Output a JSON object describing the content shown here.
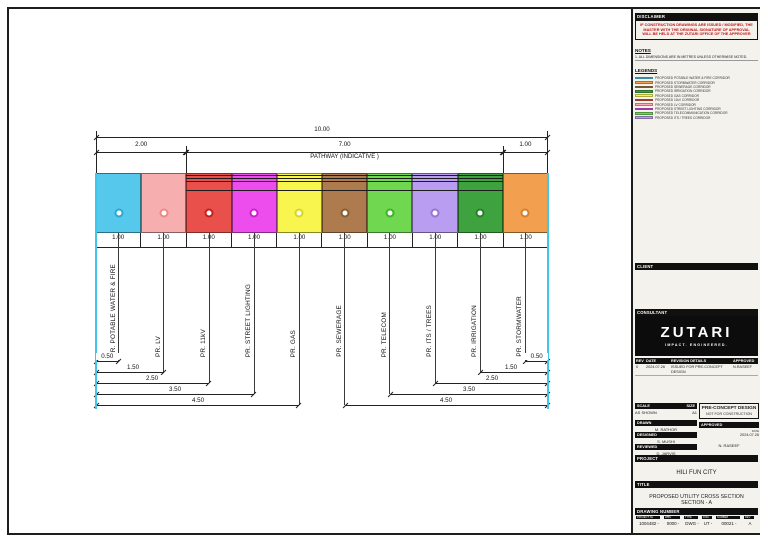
{
  "sheet": {
    "plot_stamp": "1004482-0000-DWG-UT-00021 - PROPOSED UTILITY CROSS SECTION - PRE-CONCEPT DESIGN - PLOTTED 2024.07.26"
  },
  "drawing": {
    "dims": {
      "overall": "10.00",
      "left_group": "2.00",
      "pathway_group": "7.00",
      "right_group": "1.00",
      "pathway_label": "PATHWAY (INDICATIVE )",
      "cell": "1.00",
      "left_offsets": [
        "0.50",
        "1.50",
        "2.50",
        "3.50",
        "4.50"
      ],
      "right_offsets": [
        "0.50",
        "1.50",
        "2.50",
        "3.50",
        "4.50"
      ]
    },
    "bands": [
      {
        "label": "PR. POTABLE WATER & FIRE",
        "color": "#55c8ec",
        "ring": "#29a8d4"
      },
      {
        "label": "PR. LV",
        "color": "#f7aeae",
        "ring": "#ee8888"
      },
      {
        "label": "PR. 11kV",
        "color": "#e9504b",
        "ring": "#c41f1f"
      },
      {
        "label": "PR. STREET LIGHTING",
        "color": "#ee4dee",
        "ring": "#cc22cc"
      },
      {
        "label": "PR. GAS",
        "color": "#f8f64e",
        "ring": "#d8d520"
      },
      {
        "label": "PR. SEWERAGE",
        "color": "#ad7b4e",
        "ring": "#8a5c33"
      },
      {
        "label": "PR. TELECOM",
        "color": "#6fd750",
        "ring": "#3eb327"
      },
      {
        "label": "PR. ITS / TREES",
        "color": "#b89df0",
        "ring": "#9674d8"
      },
      {
        "label": "PR. IRRIGATION",
        "color": "#3ea23f",
        "ring": "#27802a"
      },
      {
        "label": "PR. STORMWATER",
        "color": "#f2a050",
        "ring": "#d87f28"
      }
    ]
  },
  "panel": {
    "disclaimer": {
      "header": "DISCLAIMER",
      "text": "IF CONSTRUCTION DRAWINGS ARE ISSUED / MODIFIED, THE MASTER WITH THE ORIGINAL SIGNATURE OF APPROVAL WILL BE HELD AT THE ZUTARI OFFICE OF THE APPROVER"
    },
    "notes": {
      "header": "NOTES",
      "items": [
        "1.  ALL DIMENSIONS ARE IN METRES UNLESS OTHERWISE NOTED."
      ]
    },
    "legends": {
      "header": "LEGENDS",
      "items": [
        {
          "label": "PROPOSED POTABLE WATER & FIRE CORRIDOR",
          "color": "#55c8ec"
        },
        {
          "label": "PROPOSED STORMWATER CORRIDOR",
          "color": "#f2a050"
        },
        {
          "label": "PROPOSED SEWERAGE CORRIDOR",
          "color": "#ad7b4e"
        },
        {
          "label": "PROPOSED IRRIGATION CORRIDOR",
          "color": "#3ea23f"
        },
        {
          "label": "PROPOSED GAS CORRIDOR",
          "color": "#f8f64e"
        },
        {
          "label": "PROPOSED 11kV CORRIDOR",
          "color": "#e9504b"
        },
        {
          "label": "PROPOSED LV CORRIDOR",
          "color": "#f7aeae"
        },
        {
          "label": "PROPOSED STREET LIGHTING CORRIDOR",
          "color": "#ee4dee"
        },
        {
          "label": "PROPOSED TELECOMMUNICATION CORRIDOR",
          "color": "#6fd750"
        },
        {
          "label": "PROPOSED ITS / TREES CORRIDOR",
          "color": "#b89df0"
        }
      ]
    },
    "client": {
      "header": "CLIENT"
    },
    "consultant": {
      "header": "CONSULTANT",
      "logo": "ZUTARI",
      "tagline": "IMPACT. ENGINEERED."
    },
    "revisions": {
      "headers": [
        "REV",
        "DATE",
        "REVISION DETAILS",
        "APPROVED"
      ],
      "rows": [
        [
          "0",
          "2024.07.26",
          "ISSUED FOR PRE-CONCEPT DESIGN",
          "N.RASEEF"
        ]
      ]
    },
    "scale": {
      "label": "SCALE",
      "value": "AS SHOWN",
      "size_label": "SIZE",
      "size_value": "A1"
    },
    "status_box": {
      "line1": "PRE-CONCEPT DESIGN",
      "line2": "NOT FOR CONSTRUCTION"
    },
    "signoff": {
      "drawn_label": "DRAWN",
      "drawn": "M. RATHOR",
      "designed_label": "DESIGNED",
      "designed": "S. MUSHI",
      "reviewed_label": "REVIEWED",
      "reviewed": "D. JARVIS",
      "approved_label": "APPROVED",
      "date_label": "DATE",
      "approved_date": "2024.07.26",
      "approved_name": "N. RASEEF"
    },
    "project": {
      "header": "PROJECT",
      "name": "HILI FUN CITY"
    },
    "title": {
      "header": "TITLE",
      "line1": "PROPOSED UTILITY CROSS SECTION",
      "line2": "SECTION - A"
    },
    "drawing_number": {
      "header": "DRAWING NUMBER",
      "segments": [
        {
          "label": "PROJECT No.",
          "value": "1004482"
        },
        {
          "label": "WBS",
          "value": "0000"
        },
        {
          "label": "TYPE",
          "value": "DWG"
        },
        {
          "label": "DISC",
          "value": "UT"
        },
        {
          "label": "NUMBER",
          "value": "00021"
        },
        {
          "label": "REV",
          "value": "A"
        }
      ]
    }
  }
}
